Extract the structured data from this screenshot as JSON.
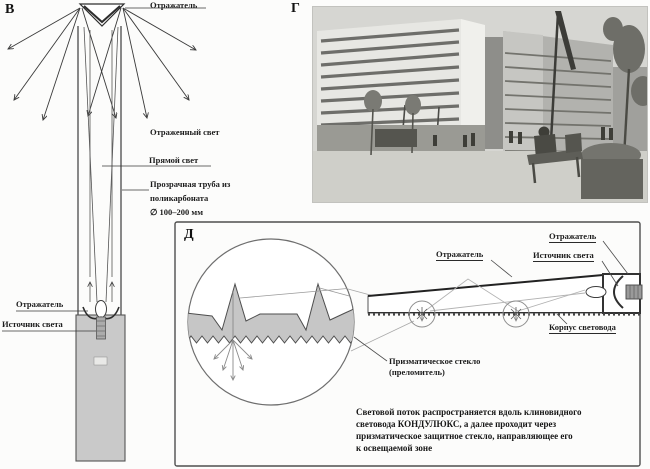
{
  "panel_b": {
    "label": "В",
    "reflector_top": "Отражатель",
    "reflected_light": "Отраженный свет",
    "direct_light": "Прямой свет",
    "tube_line1": "Прозрачная труба из",
    "tube_line2": "поликарбоната",
    "tube_line3": "∅ 100–200 мм",
    "reflector_bottom": "Отражатель",
    "light_source": "Источник света"
  },
  "panel_g": {
    "label": "Г"
  },
  "panel_d": {
    "label": "Д",
    "reflector_left": "Отражатель",
    "reflector_right": "Отражатель",
    "light_source": "Источник света",
    "housing": "Корпус световода",
    "prism_line1": "Призматическое стекло",
    "prism_line2": "(преломитель)",
    "caption_line1": "Световой поток распространяется вдоль клиновидного",
    "caption_line2": "световода КОНДУЛЮКС, а далее проходит через",
    "caption_line3": "призматическое защитное стекло, направляющее его",
    "caption_line4": "к освещаемой зоне"
  },
  "colors": {
    "line": "#3a3a3a",
    "pole_gray": "#c9c9c9",
    "prism_gray": "#c6c6c6"
  }
}
